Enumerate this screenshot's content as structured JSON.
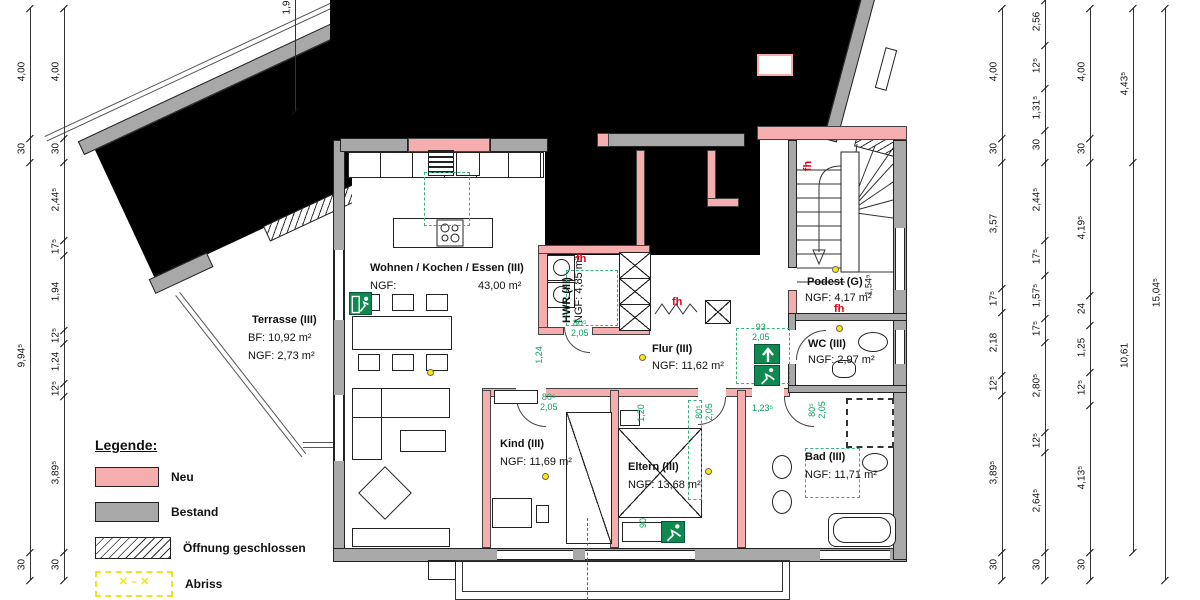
{
  "legend": {
    "title": "Legende:",
    "items": [
      {
        "label": "Neu",
        "type": "new"
      },
      {
        "label": "Bestand",
        "type": "existing"
      },
      {
        "label": "Öffnung geschlossen",
        "type": "closed-opening"
      },
      {
        "label": "Abriss",
        "type": "demolition"
      }
    ]
  },
  "rooms": {
    "wohnen": {
      "name": "Wohnen / Kochen / Essen (III)",
      "sub": "NGF:",
      "area": "43,00 m²"
    },
    "terrasse": {
      "name": "Terrasse (III)",
      "sub": "BF:  10,92 m²",
      "sub2": "NGF: 2,73 m²"
    },
    "hwr": {
      "name": "HWR (III)",
      "sub": "NGF: 4,85 m²"
    },
    "flur": {
      "name": "Flur (III)",
      "sub": "NGF: 11,62 m²"
    },
    "kind": {
      "name": "Kind (III)",
      "sub": "NGF: 11,69 m²"
    },
    "eltern": {
      "name": "Eltern (III)",
      "sub": "NGF: 13,68 m²"
    },
    "podest": {
      "name": "Podest (G)",
      "sub": "NGF: 4,17 m²"
    },
    "wc": {
      "name": "WC (III)",
      "sub": "NGF: 2,97 m²"
    },
    "bad": {
      "name": "Bad (III)",
      "sub": "NGF: 11,71 m²"
    }
  },
  "labels": {
    "fh": "fh"
  },
  "dims": {
    "left_outer": [
      "4,00",
      "30",
      "9,94⁵",
      "30"
    ],
    "left_inner": [
      "4,00",
      "30",
      "2,44⁵",
      "17⁵",
      "1,94",
      "12⁵",
      "1,24",
      "12⁵",
      "3,89⁵",
      "30"
    ],
    "top_partial": "1,9",
    "right_1": [
      "4,00",
      "30",
      "3,57",
      "17⁵",
      "2,18",
      "12⁵",
      "3,89⁵",
      "30"
    ],
    "right_2": [
      "2,56",
      "12⁵",
      "1,31⁵",
      "30",
      "2,44⁵",
      "17⁵",
      "1,57⁵",
      "17⁵",
      "2,80⁵",
      "12⁵",
      "2,64⁵",
      "30"
    ],
    "right_3": [
      "4,00",
      "30",
      "4,19⁵",
      "24",
      "1,25",
      "12⁵",
      "4,13⁵",
      "30"
    ],
    "right_4": [
      "4,43⁵",
      "10,61"
    ],
    "right_5": [
      "15,04⁵"
    ],
    "podest": "1,54⁵"
  },
  "green_dims": {
    "flur_v": {
      "a": "1,24"
    },
    "hwr_door": {
      "a": "80⁵",
      "b": "2,05"
    },
    "wc_door": {
      "a": "93",
      "b": "2,05"
    },
    "kind_door": {
      "a": "80⁵",
      "b": "2,05"
    },
    "eltern_door": {
      "a": "80⁵",
      "b": "2,05"
    },
    "bad_door": {
      "a": "80⁵",
      "b": "2,05"
    },
    "hall": {
      "a": "1,23⁵"
    },
    "eltern_v": {
      "a": "1,20"
    },
    "eltern_b": {
      "a": "90"
    }
  },
  "colors": {
    "neu": "#f6adad",
    "bestand": "#a8a8a8",
    "abriss": "#ece51f",
    "green": "#0ca05e",
    "fh_red": "#e30016",
    "lamp": "#ffe800"
  }
}
